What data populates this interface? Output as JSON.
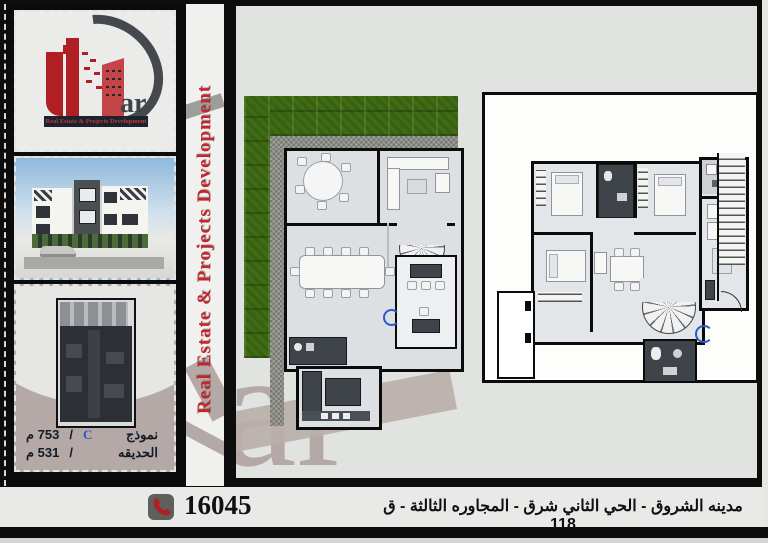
{
  "brand": {
    "wordmark": "ar",
    "tagline": "Real Estate & Projects Development",
    "vertical_banner": "Real Estate & Projects Development",
    "watermark": "ar"
  },
  "model_info": {
    "model_label": "نموذج",
    "model_code": "C",
    "separator": "/",
    "model_area": "357 م",
    "garden_label": "الحديقه",
    "garden_area": "135 م"
  },
  "footer": {
    "phone": "16045",
    "location": "مدينه الشروق - الحي الثاني شرق - المجاوره الثالثة - ق 118"
  },
  "colors": {
    "accent_red": "#c0272d",
    "logo_red": "#b01f24",
    "grass_green": "#3e6b14",
    "dark_room": "#3f444a",
    "watermark_mauve": "#b4a9a6"
  }
}
